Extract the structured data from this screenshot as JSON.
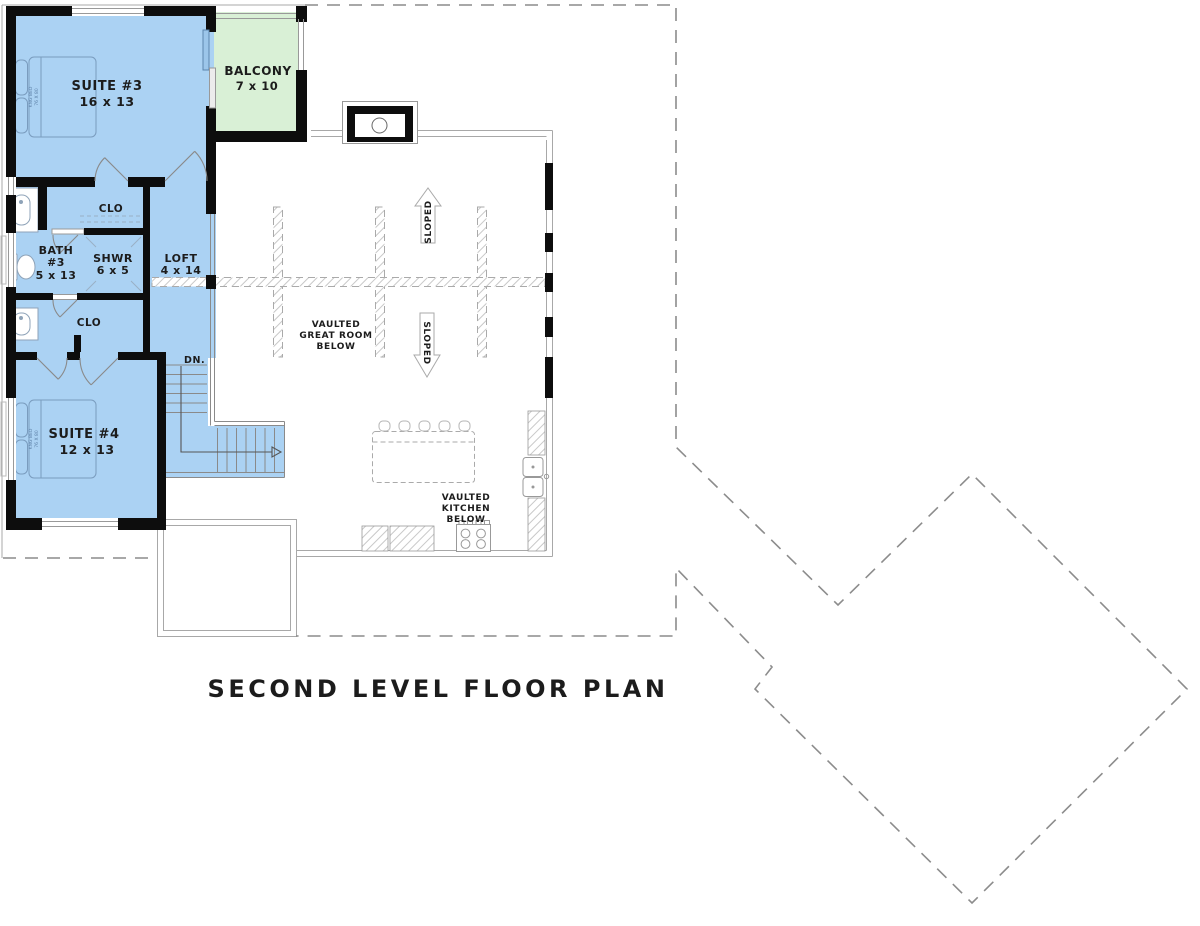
{
  "title": "SECOND LEVEL FLOOR PLAN",
  "colors": {
    "room_blue": "#abd2f3",
    "balcony_green": "#d9f0d6",
    "wall_black": "#0d0d0d",
    "line_gray": "#999999"
  },
  "rooms": {
    "suite3": {
      "name": "SUITE #3",
      "dims": "16 x 13"
    },
    "balcony": {
      "name": "BALCONY",
      "dims": "7 x 10"
    },
    "bath3": {
      "name": "BATH",
      "num": "#3",
      "dims": "5 x 13"
    },
    "shower": {
      "name": "SHWR",
      "dims": "6 x 5"
    },
    "loft": {
      "name": "LOFT",
      "dims": "4 x 14"
    },
    "closet_upper": {
      "name": "CLO"
    },
    "closet_lower": {
      "name": "CLO"
    },
    "suite4": {
      "name": "SUITE #4",
      "dims": "12 x 13"
    }
  },
  "annotations": {
    "great_room": {
      "line1": "VAULTED",
      "line2": "GREAT ROOM",
      "line3": "BELOW"
    },
    "kitchen": {
      "line1": "VAULTED",
      "line2": "KITCHEN",
      "line3": "BELOW"
    },
    "sloped_up": "SLOPED",
    "sloped_down": "SLOPED",
    "stair_down": "DN.",
    "bed3": {
      "line1": "KNG BED",
      "line2": "76 X 80"
    },
    "bed4": {
      "line1": "KNG BED",
      "line2": "76 X 80"
    }
  }
}
